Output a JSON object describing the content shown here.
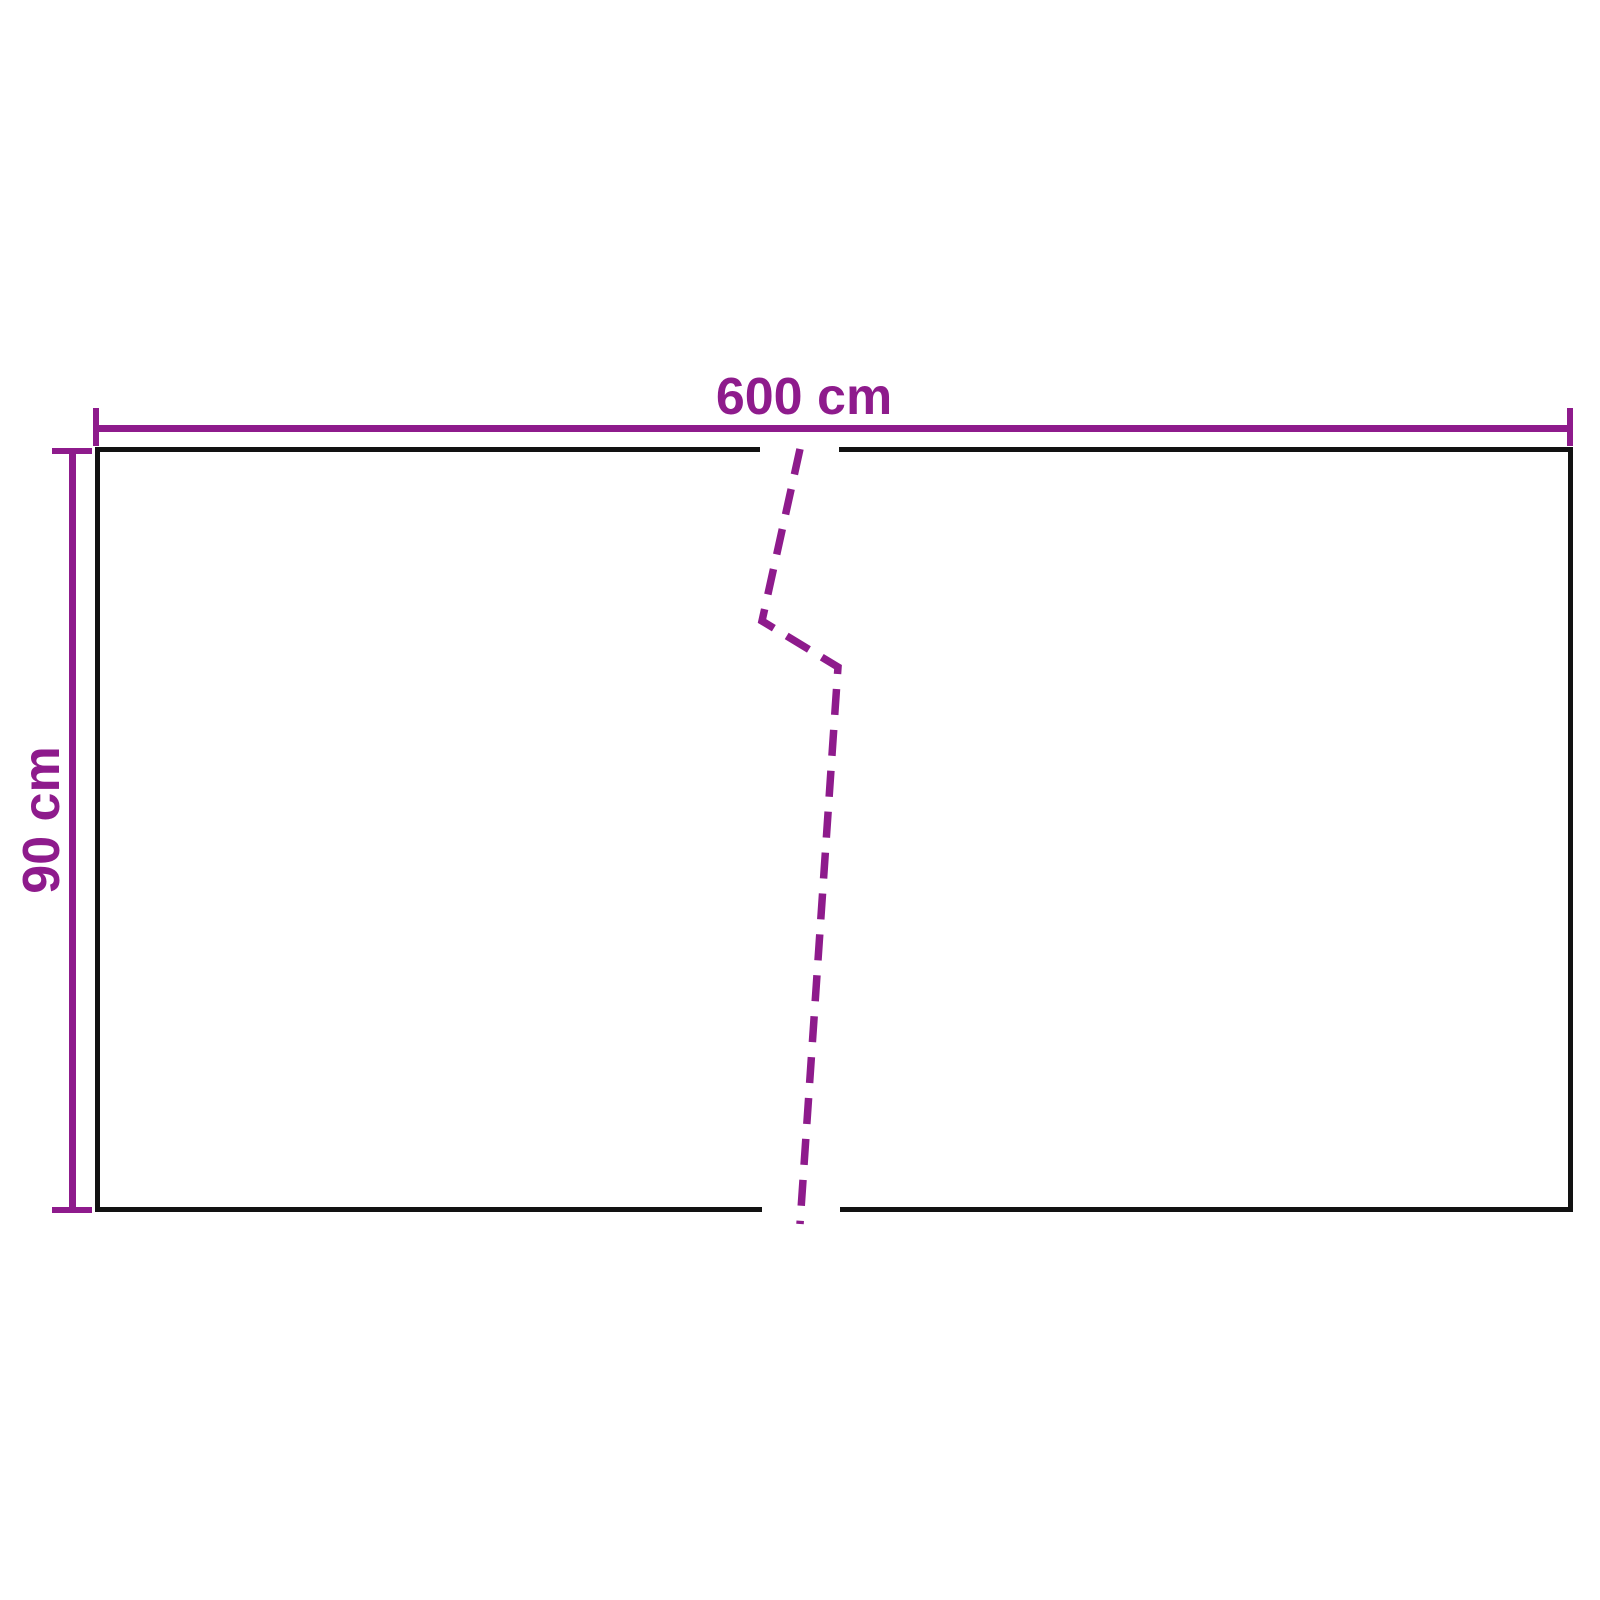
{
  "diagram": {
    "title": "panel-dimension-diagram",
    "width_label": "600 cm",
    "height_label": "90 cm",
    "width_value_cm": 600,
    "height_value_cm": 90
  },
  "colors": {
    "dimension": "#8E1B8C",
    "outline": "#121212",
    "background": "#FFFFFF"
  }
}
